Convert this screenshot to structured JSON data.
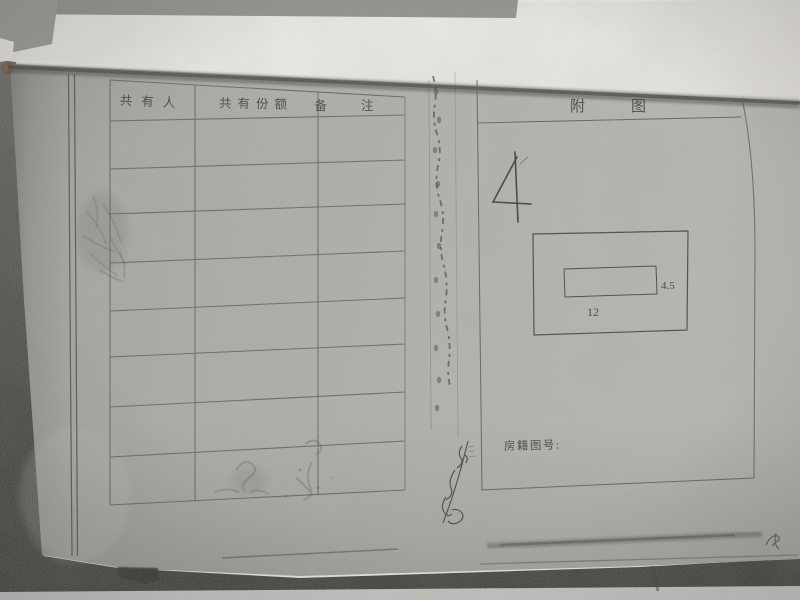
{
  "colors": {
    "paper_gray": "#aaa9a4",
    "white_page": "#f7f6f2",
    "ink": "#3c3a36",
    "desk_dark": "#44423e",
    "floor_strip": "#c5c4bf"
  },
  "co_owner_table": {
    "headers": [
      "共有人",
      "共有份额",
      "备注"
    ],
    "empty_data_rows": 8
  },
  "attached_figure_panel": {
    "title": "附图",
    "handwritten_number": "4",
    "floor_plan": {
      "width_label": "12",
      "height_label": "4.5"
    },
    "registry_label": "房籍图号:"
  }
}
